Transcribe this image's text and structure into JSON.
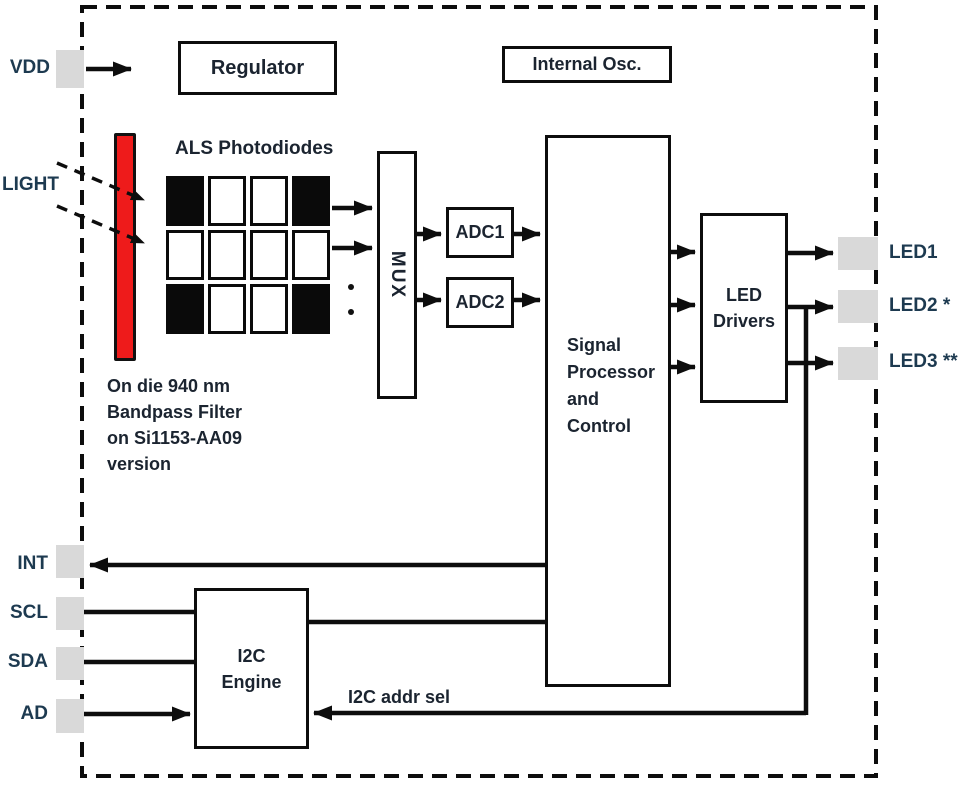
{
  "ports": {
    "vdd": "VDD",
    "light": "LIGHT",
    "int": "INT",
    "scl": "SCL",
    "sda": "SDA",
    "ad": "AD",
    "led1": "LED1",
    "led2": "LED2 *",
    "led3": "LED3 **"
  },
  "blocks": {
    "regulator": "Regulator",
    "internal_osc": "Internal Osc.",
    "mux": "MUX",
    "adc1": "ADC1",
    "adc2": "ADC2",
    "signal_processor": {
      "lines": [
        "Signal",
        "Processor",
        "and",
        "Control"
      ]
    },
    "led_drivers": {
      "lines": [
        "LED",
        "Drivers"
      ]
    },
    "i2c_engine": {
      "lines": [
        "I2C",
        "Engine"
      ]
    }
  },
  "annotations": {
    "als_photodiodes": "ALS Photodiodes",
    "bandpass_note": {
      "lines": [
        "On die 940 nm",
        "Bandpass Filter",
        "on Si1153-AA09",
        "version"
      ]
    },
    "i2c_addr_sel": "I2C addr sel"
  },
  "photodiode_grid": {
    "rows": 3,
    "cols": 4,
    "pattern": [
      [
        "black",
        "white",
        "white",
        "black"
      ],
      [
        "white",
        "white",
        "white",
        "white"
      ],
      [
        "black",
        "white",
        "white",
        "black"
      ]
    ]
  },
  "colors": {
    "filter_red": "#ee1b1b",
    "pin_gray": "#d9d9d9",
    "wire_black": "#0d0d0d",
    "port_label_navy": "#1d3a50"
  }
}
